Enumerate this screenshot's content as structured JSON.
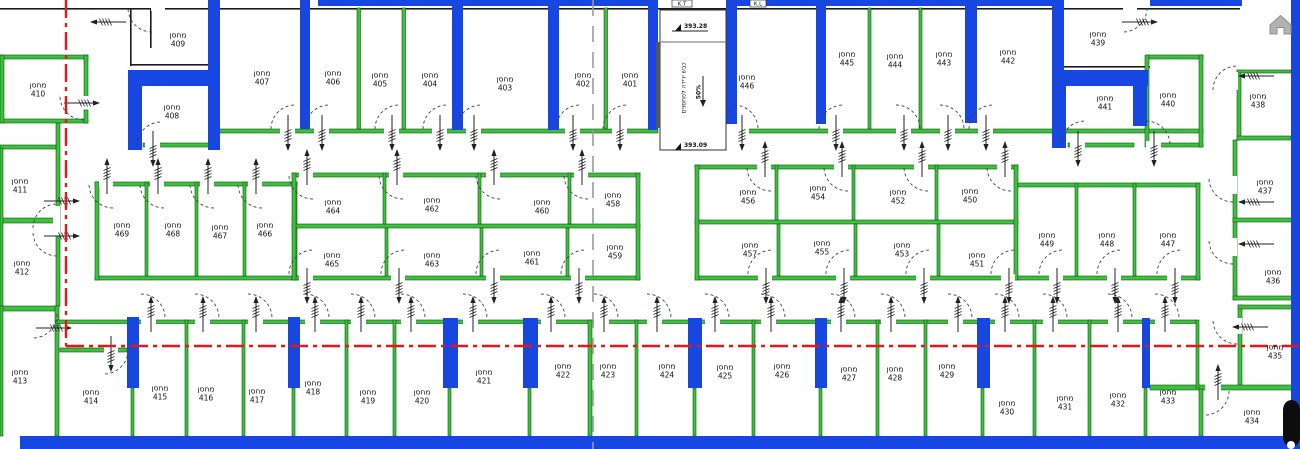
{
  "plan": {
    "room_prefix": "מחסן",
    "top_markers": [
      "K.T",
      "K.L"
    ],
    "ramp": {
      "label": "כבש ירידה למחסנים",
      "slope": "50%"
    },
    "levels": {
      "top": "393.28",
      "bottom": "393.09"
    },
    "colors": {
      "slab_blue": "#1747e0",
      "wall_green": "#3fbf3f",
      "axis_red": "#e61717",
      "section_gray": "#9b9b9b"
    },
    "rooms": [
      {
        "n": "401",
        "x": 630,
        "y": 80
      },
      {
        "n": "402",
        "x": 583,
        "y": 80
      },
      {
        "n": "403",
        "x": 505,
        "y": 84
      },
      {
        "n": "404",
        "x": 430,
        "y": 80
      },
      {
        "n": "405",
        "x": 380,
        "y": 80
      },
      {
        "n": "406",
        "x": 333,
        "y": 78
      },
      {
        "n": "407",
        "x": 262,
        "y": 78
      },
      {
        "n": "408",
        "x": 172,
        "y": 112
      },
      {
        "n": "409",
        "x": 178,
        "y": 40
      },
      {
        "n": "410",
        "x": 38,
        "y": 90
      },
      {
        "n": "411",
        "x": 20,
        "y": 186
      },
      {
        "n": "412",
        "x": 22,
        "y": 268
      },
      {
        "n": "413",
        "x": 20,
        "y": 377
      },
      {
        "n": "414",
        "x": 91,
        "y": 397
      },
      {
        "n": "415",
        "x": 160,
        "y": 393
      },
      {
        "n": "416",
        "x": 206,
        "y": 394
      },
      {
        "n": "417",
        "x": 257,
        "y": 396
      },
      {
        "n": "418",
        "x": 313,
        "y": 388
      },
      {
        "n": "419",
        "x": 368,
        "y": 397
      },
      {
        "n": "420",
        "x": 422,
        "y": 397
      },
      {
        "n": "421",
        "x": 484,
        "y": 377
      },
      {
        "n": "422",
        "x": 563,
        "y": 371
      },
      {
        "n": "423",
        "x": 608,
        "y": 371
      },
      {
        "n": "424",
        "x": 667,
        "y": 371
      },
      {
        "n": "425",
        "x": 725,
        "y": 372
      },
      {
        "n": "426",
        "x": 782,
        "y": 371
      },
      {
        "n": "427",
        "x": 849,
        "y": 374
      },
      {
        "n": "428",
        "x": 895,
        "y": 374
      },
      {
        "n": "429",
        "x": 947,
        "y": 371
      },
      {
        "n": "430",
        "x": 1007,
        "y": 408
      },
      {
        "n": "431",
        "x": 1065,
        "y": 403
      },
      {
        "n": "432",
        "x": 1118,
        "y": 400
      },
      {
        "n": "433",
        "x": 1168,
        "y": 397
      },
      {
        "n": "434",
        "x": 1252,
        "y": 417
      },
      {
        "n": "435",
        "x": 1275,
        "y": 352
      },
      {
        "n": "436",
        "x": 1273,
        "y": 277
      },
      {
        "n": "437",
        "x": 1265,
        "y": 187
      },
      {
        "n": "438",
        "x": 1258,
        "y": 101
      },
      {
        "n": "439",
        "x": 1098,
        "y": 39
      },
      {
        "n": "440",
        "x": 1168,
        "y": 100
      },
      {
        "n": "441",
        "x": 1105,
        "y": 103
      },
      {
        "n": "442",
        "x": 1008,
        "y": 57
      },
      {
        "n": "443",
        "x": 944,
        "y": 59
      },
      {
        "n": "444",
        "x": 895,
        "y": 61
      },
      {
        "n": "445",
        "x": 847,
        "y": 59
      },
      {
        "n": "446",
        "x": 747,
        "y": 82
      },
      {
        "n": "447",
        "x": 1168,
        "y": 240
      },
      {
        "n": "448",
        "x": 1107,
        "y": 240
      },
      {
        "n": "449",
        "x": 1047,
        "y": 240
      },
      {
        "n": "450",
        "x": 970,
        "y": 196
      },
      {
        "n": "451",
        "x": 977,
        "y": 260
      },
      {
        "n": "452",
        "x": 898,
        "y": 197
      },
      {
        "n": "453",
        "x": 902,
        "y": 250
      },
      {
        "n": "454",
        "x": 818,
        "y": 193
      },
      {
        "n": "455",
        "x": 822,
        "y": 248
      },
      {
        "n": "456",
        "x": 748,
        "y": 197
      },
      {
        "n": "457",
        "x": 750,
        "y": 250
      },
      {
        "n": "458",
        "x": 613,
        "y": 200
      },
      {
        "n": "459",
        "x": 615,
        "y": 252
      },
      {
        "n": "460",
        "x": 542,
        "y": 207
      },
      {
        "n": "461",
        "x": 532,
        "y": 258
      },
      {
        "n": "462",
        "x": 432,
        "y": 205
      },
      {
        "n": "463",
        "x": 432,
        "y": 260
      },
      {
        "n": "464",
        "x": 333,
        "y": 207
      },
      {
        "n": "465",
        "x": 332,
        "y": 260
      },
      {
        "n": "466",
        "x": 265,
        "y": 230
      },
      {
        "n": "467",
        "x": 220,
        "y": 232
      },
      {
        "n": "468",
        "x": 173,
        "y": 230
      },
      {
        "n": "469",
        "x": 122,
        "y": 230
      }
    ]
  }
}
